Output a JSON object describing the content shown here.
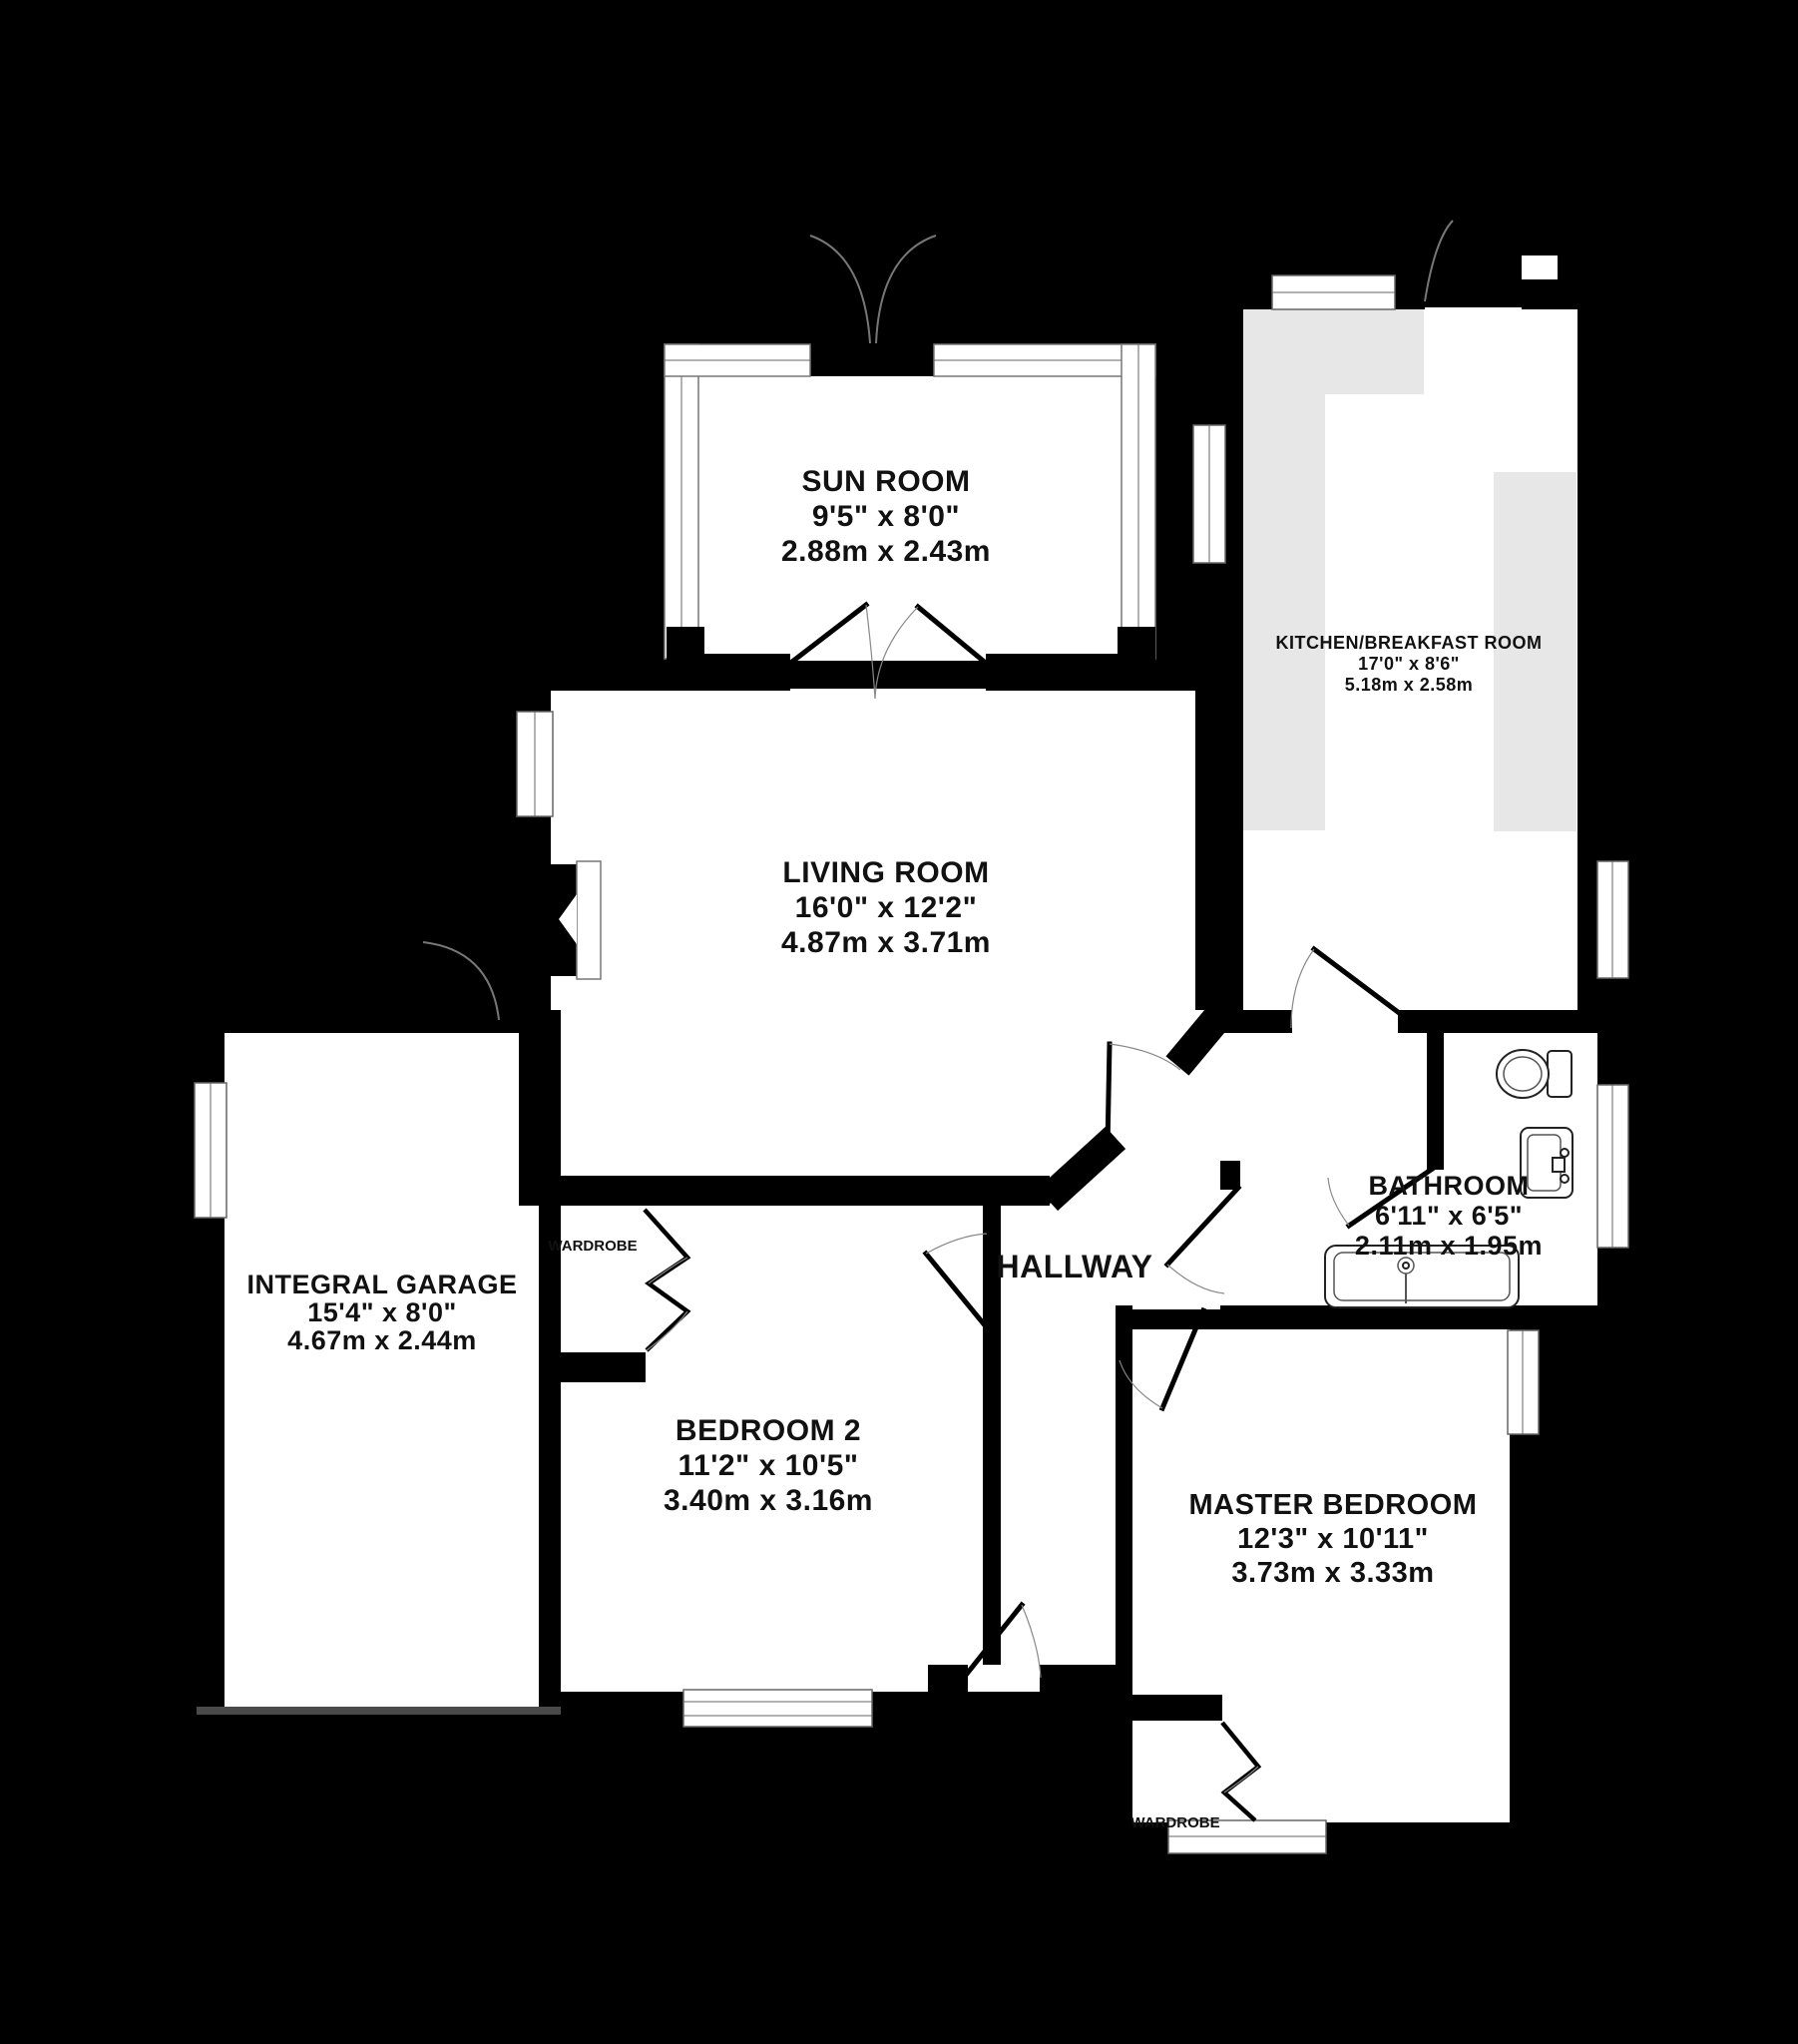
{
  "rooms": {
    "sun_room": {
      "name": "SUN ROOM",
      "imperial": "9'5\"  x 8'0\"",
      "metric": "2.88m  x 2.43m"
    },
    "kitchen": {
      "name": "KITCHEN/BREAKFAST ROOM",
      "imperial": "17'0\"  x 8'6\"",
      "metric": "5.18m  x 2.58m"
    },
    "living_room": {
      "name": "LIVING ROOM",
      "imperial": "16'0\"  x 12'2\"",
      "metric": "4.87m  x 3.71m"
    },
    "garage": {
      "name": "INTEGRAL GARAGE",
      "imperial": "15'4\"  x 8'0\"",
      "metric": "4.67m  x 2.44m"
    },
    "bathroom": {
      "name": "BATHROOM",
      "imperial": "6'11\"  x 6'5\"",
      "metric": "2.11m  x 1.95m"
    },
    "hallway": {
      "name": "HALLWAY"
    },
    "bedroom_2": {
      "name": "BEDROOM 2",
      "imperial": "11'2\"  x 10'5\"",
      "metric": "3.40m  x 3.16m"
    },
    "master_bedroom": {
      "name": "MASTER BEDROOM",
      "imperial": "12'3\"  x 10'11\"",
      "metric": "3.73m  x 3.33m"
    },
    "wardrobe_bedroom_2": {
      "label": "WARDROBE"
    },
    "wardrobe_master": {
      "label": "WARDROBE"
    }
  },
  "colors": {
    "background": "#000000",
    "floor": "#ffffff",
    "wall": "#000000",
    "counter": "#e7e7e7",
    "door_arc": "#777777",
    "fixture_outline": "#222222",
    "text": "#111111"
  }
}
